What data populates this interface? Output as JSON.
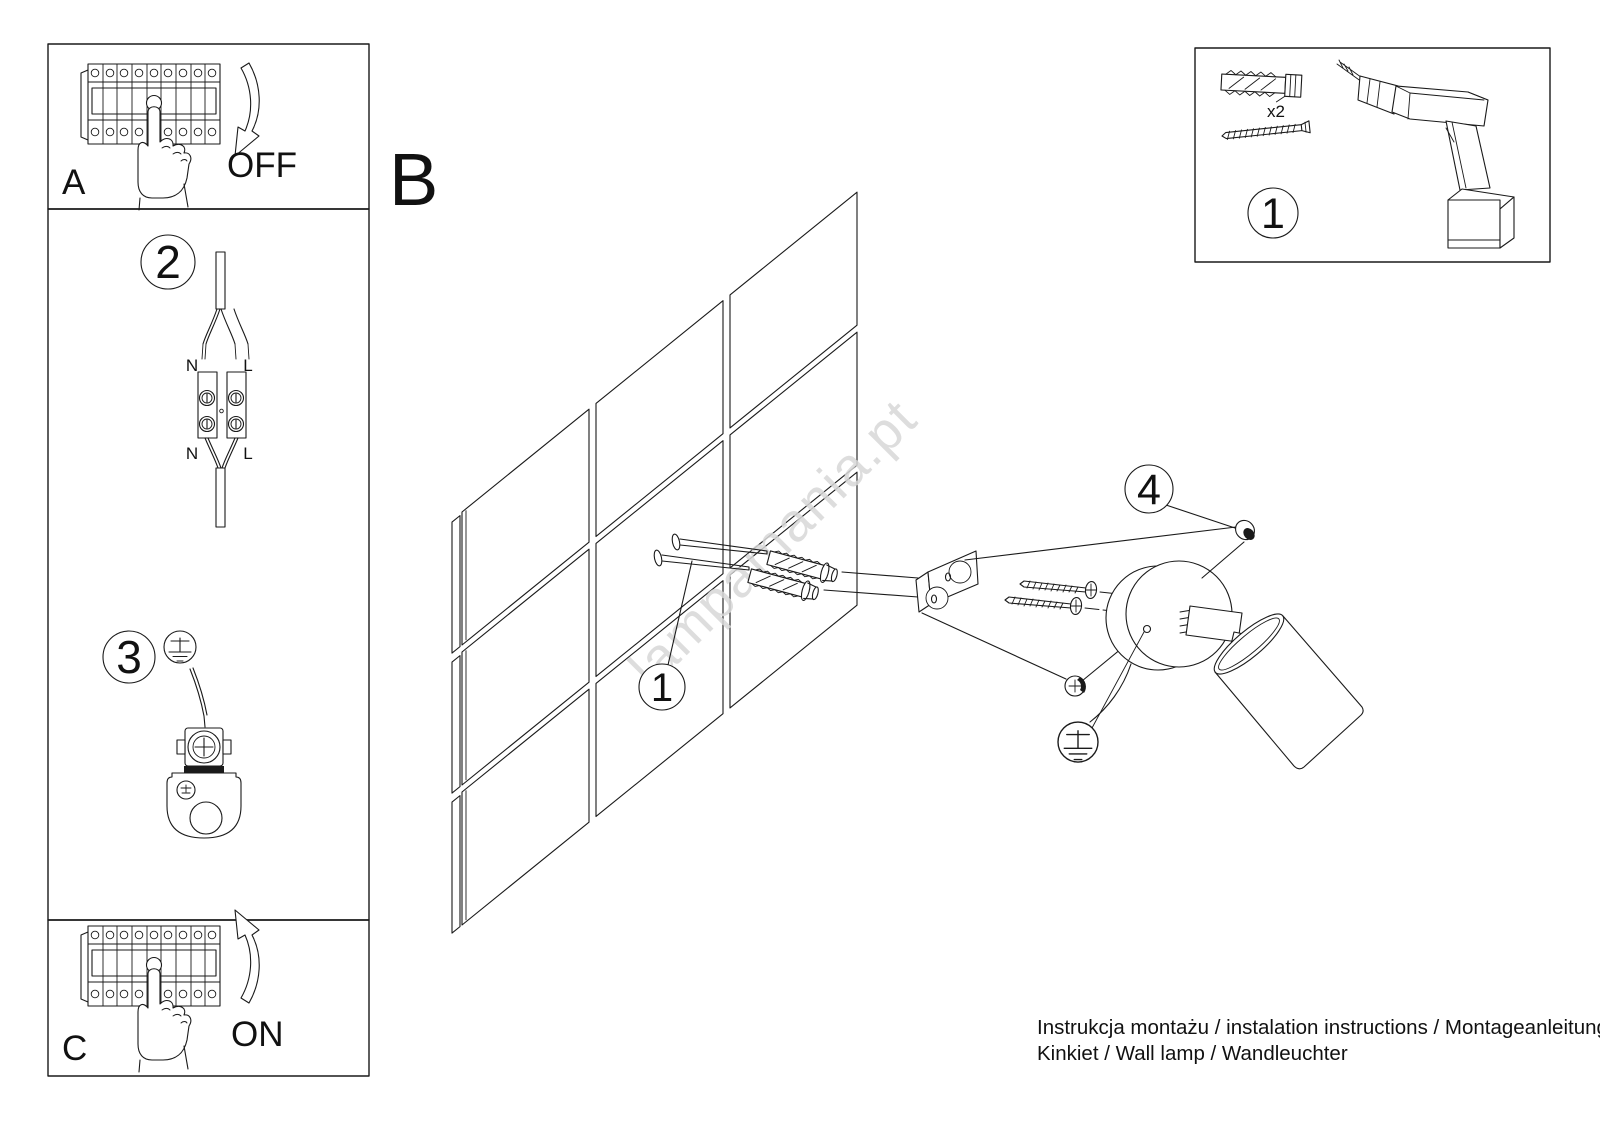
{
  "colors": {
    "line": "#1a1a1a",
    "watermark": "#d8d8d8",
    "paper": "#ffffff"
  },
  "panels": {
    "a_label": "A",
    "a_action": "OFF",
    "c_label": "C",
    "c_action": "ON"
  },
  "section_label": "B",
  "callouts": {
    "step2": "2",
    "step3": "3",
    "wall_plugs": "1",
    "hardware_kit": "1",
    "adjust_screw": "4"
  },
  "wiring": {
    "n_top": "N",
    "l_top": "L",
    "n_bottom": "N",
    "l_bottom": "L"
  },
  "hardware_box": {
    "plug_qty": "x2"
  },
  "watermark": "lampamania.pt",
  "footer": {
    "line1": "Instrukcja montażu / instalation instructions / Montageanleitung",
    "line2": "Kinkiet / Wall lamp / Wandleuchter"
  },
  "icons": {
    "breaker": "circuit-breaker-panel-icon",
    "hand": "pointing-hand-icon",
    "arrow_down": "curved-arrow-down-icon",
    "arrow_up": "curved-arrow-up-icon",
    "cable": "mains-cable-icon",
    "terminal": "terminal-block-icon",
    "earth": "earth-ground-icon",
    "wall": "tiled-wall-icon",
    "screw": "screw-icon",
    "plug": "wall-plug-icon",
    "drill": "cordless-drill-icon",
    "bracket": "mounting-bracket-icon",
    "canopy": "lamp-canopy-icon",
    "shade": "lamp-shade-icon"
  }
}
